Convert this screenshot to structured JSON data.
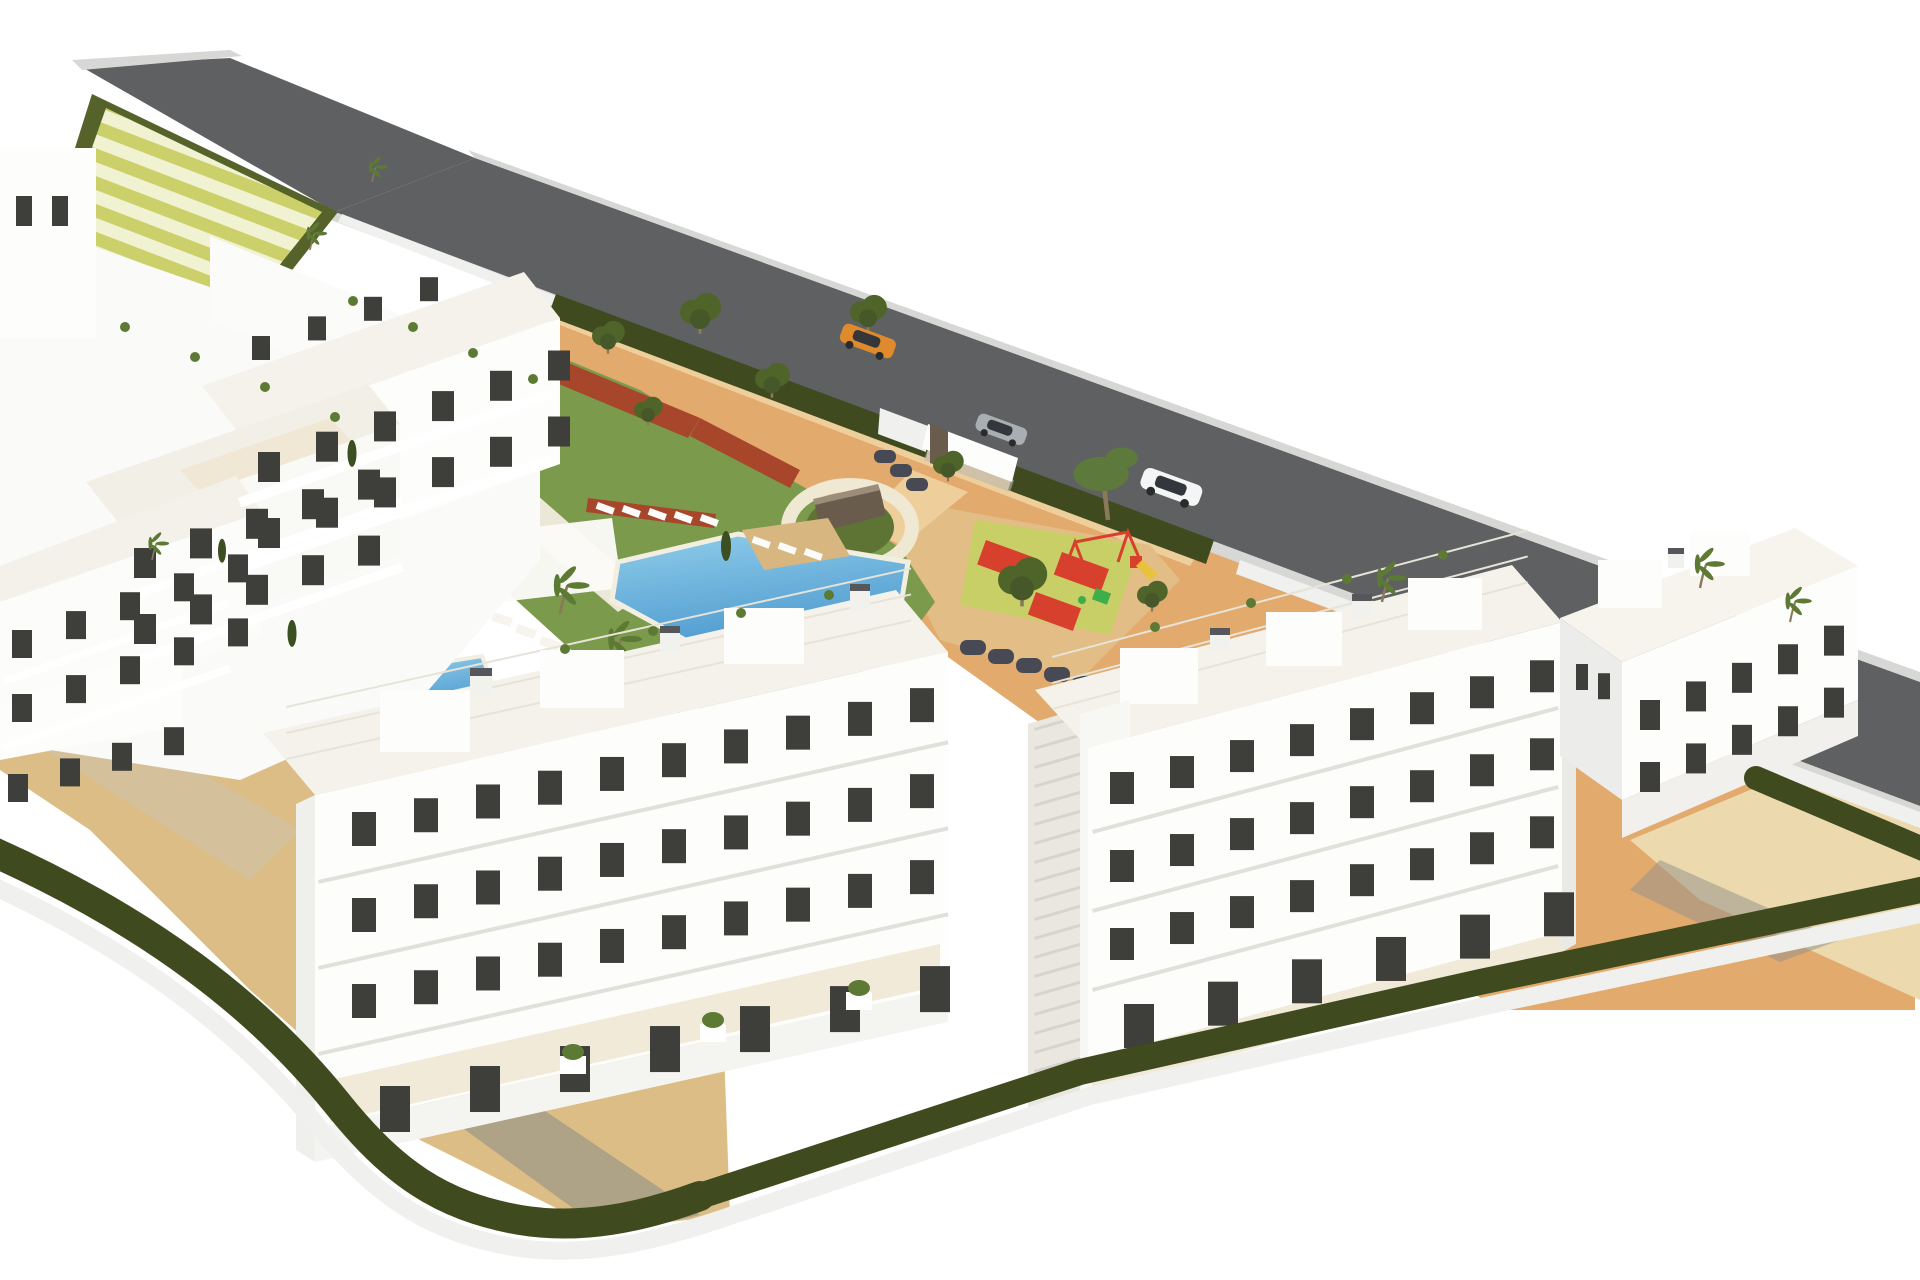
{
  "scene": {
    "type": "architectural-3d-render",
    "description": "Aerial 3D rendering of a white Mediterranean apartment complex with landscaped gardens, swimming pool, children's playground, terraced slope and a perimeter road",
    "objects": [
      "white apartment buildings with roof terraces",
      "large angled swimming pool and small pool",
      "sunbathing deck with loungers",
      "pergola",
      "stepping-stone garden path",
      "roundabout with stone monument sign",
      "children playground with red safety mats",
      "terraced slope with hedges",
      "perimeter road",
      "orange car",
      "silver car",
      "white suv",
      "perimeter hedges and boundary wall",
      "sand plaza",
      "olive trees",
      "palm trees"
    ]
  },
  "cars": [
    {
      "name": "orange-car",
      "color_key": "car_orange"
    },
    {
      "name": "silver-car",
      "color_key": "car_silver"
    },
    {
      "name": "white-suv",
      "color_key": "car_white"
    }
  ],
  "buildings": {
    "front_building_floors": 4,
    "right_building_floors": 4,
    "left_complex_terraced_wings": 4,
    "far_right_building_floors": 3
  },
  "colors": {
    "page_bg": "#ffffff",
    "road": "#5e6062",
    "road_edge": "#d7d7d5",
    "boundary_wall": "#f0f0ee",
    "hedge": "#3f4a1e",
    "hedge_light": "#55622a",
    "stripe_a": "#ccd06b",
    "stripe_b": "#f1f2d2",
    "lawn": "#7b9a4b",
    "sand": "#dcbd86",
    "sand_light": "#ecd9ad",
    "terracotta": "#e3aa6e",
    "path_tan": "#eecf9c",
    "play_sand": "#e2bd85",
    "play_mat": "#c9cf67",
    "play_red": "#d8402e",
    "play_green": "#3fae4a",
    "pool_deep": "#4f9bd0",
    "pool_light": "#90cdea",
    "pool_edge": "#f3efe0",
    "deck_tan": "#d8b680",
    "building_white": "#fdfdfc",
    "building_shade": "#ececea",
    "building_dark": "#dededa",
    "roof_light": "#f4f2ea",
    "roof_terrace": "#f0e8d5",
    "window": "#3e3e3a",
    "red_shrub": "#a8462b",
    "dark_bush": "#474a54",
    "tree_olive": "#4f6428",
    "tree_olive_dark": "#46582a",
    "tree_palm": "#5d7a35",
    "tree_pine": "#5d7a3c",
    "cypress": "#3c4f22",
    "trunk": "#8a7a5a",
    "stone_wall": "#6a5c4d",
    "stone_wall_top": "#9b8d7a",
    "shadow_dark": "#8f8f89",
    "shadow_warm": "#c9c3b4",
    "car_orange": "#e08a2e",
    "car_silver": "#a9aeb3",
    "car_white": "#f4f5f5",
    "car_glass": "#33373c",
    "step_gray": "#d6d4cc",
    "floor_line": "#e2e0da",
    "stone_white": "#f6f4ec",
    "sunbed_white": "#fbfbf9",
    "roof_grid": "#e7e3d8"
  },
  "generated": [
    {
      "t": "b1-win",
      "name": "window",
      "x0": 258,
      "y0": 452,
      "dx": 58,
      "n": 6,
      "w": 22,
      "h": 30,
      "slope": -0.35
    },
    {
      "t": "b1-win",
      "name": "window",
      "x0": 258,
      "y0": 518,
      "dx": 58,
      "n": 6,
      "w": 22,
      "h": 30,
      "slope": -0.35
    },
    {
      "t": "b1-win",
      "name": "window",
      "x0": 134,
      "y0": 548,
      "dx": 56,
      "n": 5,
      "w": 22,
      "h": 30,
      "slope": -0.35
    },
    {
      "t": "b1-win",
      "name": "window",
      "x0": 134,
      "y0": 614,
      "dx": 56,
      "n": 5,
      "w": 22,
      "h": 30,
      "slope": -0.35
    },
    {
      "t": "b1-win",
      "name": "window",
      "x0": 12,
      "y0": 630,
      "dx": 54,
      "n": 5,
      "w": 20,
      "h": 28,
      "slope": -0.35
    },
    {
      "t": "b1-win",
      "name": "window",
      "x0": 12,
      "y0": 694,
      "dx": 54,
      "n": 5,
      "w": 20,
      "h": 28,
      "slope": -0.35
    },
    {
      "t": "b1-win",
      "name": "window",
      "x0": 8,
      "y0": 774,
      "dx": 52,
      "n": 4,
      "w": 20,
      "h": 28,
      "slope": -0.3
    },
    {
      "t": "b1-win",
      "name": "window",
      "x0": 16,
      "y0": 196,
      "dx": 36,
      "n": 2,
      "w": 16,
      "h": 30
    },
    {
      "t": "b1-win",
      "name": "window",
      "x0": 252,
      "y0": 336,
      "dx": 56,
      "n": 4,
      "w": 18,
      "h": 24,
      "slope": -0.35
    },
    {
      "t": "b2-win",
      "name": "window",
      "x0": 352,
      "y0": 812,
      "dx": 62,
      "n": 10,
      "w": 24,
      "h": 34,
      "slope": -0.222
    },
    {
      "t": "b2-win",
      "name": "window",
      "x0": 352,
      "y0": 898,
      "dx": 62,
      "n": 10,
      "w": 24,
      "h": 34,
      "slope": -0.222
    },
    {
      "t": "b2-win",
      "name": "window",
      "x0": 352,
      "y0": 984,
      "dx": 62,
      "n": 10,
      "w": 24,
      "h": 34,
      "slope": -0.222
    },
    {
      "t": "b2-win",
      "name": "door",
      "x0": 380,
      "y0": 1086,
      "dx": 90,
      "n": 7,
      "w": 30,
      "h": 46,
      "slope": -0.222
    },
    {
      "t": "b3-win",
      "name": "window",
      "x0": 1110,
      "y0": 772,
      "dx": 60,
      "n": 8,
      "w": 24,
      "h": 32,
      "slope": -0.266
    },
    {
      "t": "b3-win",
      "name": "window",
      "x0": 1110,
      "y0": 850,
      "dx": 60,
      "n": 8,
      "w": 24,
      "h": 32,
      "slope": -0.266
    },
    {
      "t": "b3-win",
      "name": "window",
      "x0": 1110,
      "y0": 928,
      "dx": 60,
      "n": 8,
      "w": 24,
      "h": 32,
      "slope": -0.266
    },
    {
      "t": "b3-win",
      "name": "door",
      "x0": 1124,
      "y0": 1004,
      "dx": 84,
      "n": 6,
      "w": 30,
      "h": 44,
      "slope": -0.266
    },
    {
      "t": "b4-win",
      "name": "window",
      "x0": 1640,
      "y0": 700,
      "dx": 46,
      "n": 5,
      "w": 20,
      "h": 30,
      "slope": -0.404
    },
    {
      "t": "b4-win",
      "name": "window",
      "x0": 1640,
      "y0": 762,
      "dx": 46,
      "n": 5,
      "w": 20,
      "h": 30,
      "slope": -0.404
    },
    {
      "t": "b4-win",
      "name": "window",
      "x0": 1576,
      "y0": 664,
      "dx": 22,
      "n": 2,
      "w": 12,
      "h": 26,
      "slope": 0.42
    },
    {
      "t": "steps",
      "name": "stair-step",
      "x0": 1034,
      "y0": 728,
      "dy": 19,
      "n": 19,
      "w": 52,
      "h": 3,
      "rot": -16
    },
    {
      "t": "b2-lines",
      "name": "floor-shadow",
      "x0": 318,
      "y0": 880,
      "dy": 86,
      "n": 3,
      "w": 645,
      "h": 4,
      "rot": -12.5
    },
    {
      "t": "b3-lines",
      "name": "floor-shadow",
      "x0": 1092,
      "y0": 830,
      "dy": 79,
      "n": 3,
      "w": 482,
      "h": 4,
      "rot": -14.9
    },
    {
      "t": "b1-slabs",
      "name": "balcony-slab",
      "x0": 238,
      "y0": 498,
      "dy": 66,
      "n": 2,
      "w": 330,
      "h": 10,
      "rot": -19.3
    },
    {
      "t": "b1-slabs",
      "name": "balcony-slab",
      "x0": 118,
      "y0": 596,
      "dy": 66,
      "n": 2,
      "w": 300,
      "h": 9,
      "rot": -19.3
    },
    {
      "t": "b1-slabs",
      "name": "balcony-slab",
      "x0": 2,
      "y0": 678,
      "dy": 66,
      "n": 2,
      "w": 240,
      "h": 8,
      "rot": -19.3
    },
    {
      "t": "stones",
      "name": "stepping-stone",
      "x0": 470,
      "y0": 600,
      "dx": 24,
      "dy": 12,
      "n": 13,
      "w": 20,
      "h": 9,
      "rot": 19
    },
    {
      "t": "stones",
      "name": "stepping-stone",
      "x0": 784,
      "y0": 740,
      "dx": 26,
      "dy": -7,
      "n": 4,
      "w": 20,
      "h": 9,
      "rot": 10
    },
    {
      "t": "sunbeds",
      "name": "sunbed",
      "x0": 598,
      "y0": 502,
      "dx": 26,
      "dy": 3,
      "n": 5,
      "w": 18,
      "h": 7,
      "rot": 20
    },
    {
      "t": "sunbeds",
      "name": "sunbed",
      "x0": 754,
      "y0": 536,
      "dx": 26,
      "dy": 6,
      "n": 3,
      "w": 18,
      "h": 7,
      "rot": 20
    },
    {
      "t": "sunbeds",
      "name": "sunbed",
      "x0": 418,
      "y0": 722,
      "dx": 26,
      "dy": 6,
      "n": 3,
      "w": 18,
      "h": 7,
      "rot": 20
    },
    {
      "t": "bushes",
      "name": "bush",
      "x0": 318,
      "y0": 464,
      "dx": 11,
      "dy": 27,
      "n": 5,
      "w": 24,
      "h": 16,
      "rx": 7
    },
    {
      "t": "bushes",
      "name": "bush",
      "x0": 960,
      "y0": 640,
      "dx": 28,
      "dy": 9,
      "n": 5,
      "w": 26,
      "h": 15,
      "rx": 7
    },
    {
      "t": "bushes",
      "name": "bush",
      "x0": 874,
      "y0": 450,
      "dx": 16,
      "dy": 14,
      "n": 3,
      "w": 22,
      "h": 13,
      "rx": 6
    },
    {
      "t": "redshrub-dots",
      "name": "shrub",
      "x0": 770,
      "y0": 536,
      "dx": 13,
      "dy": 12,
      "n": 4,
      "w": 12,
      "h": 9,
      "rx": 4
    },
    {
      "t": "b2-roofgrid",
      "name": "roof-line",
      "x0": 286,
      "y0": 706,
      "dy": 26,
      "n": 3,
      "w": 640,
      "h": 2,
      "rot": -12.5
    },
    {
      "t": "b3-roofgrid",
      "name": "roof-line",
      "x0": 1052,
      "y0": 656,
      "dy": 26,
      "n": 3,
      "w": 492,
      "h": 2,
      "rot": -14.9
    },
    {
      "t": "roof-plants",
      "name": "roof-plant",
      "x0": 348,
      "y0": 296,
      "dx": 60,
      "dy": 26,
      "n": 4,
      "w": 10,
      "h": 10,
      "rx": 5
    },
    {
      "t": "roof-plants",
      "name": "roof-plant",
      "x0": 560,
      "y0": 644,
      "dx": 88,
      "dy": -18,
      "n": 4,
      "w": 10,
      "h": 10,
      "rx": 5
    },
    {
      "t": "roof-plants",
      "name": "roof-plant",
      "x0": 1150,
      "y0": 622,
      "dx": 96,
      "dy": -24,
      "n": 4,
      "w": 10,
      "h": 10,
      "rx": 5
    },
    {
      "t": "roof-plants",
      "name": "roof-plant",
      "x0": 120,
      "y0": 322,
      "dx": 70,
      "dy": 30,
      "n": 4,
      "w": 10,
      "h": 10,
      "rx": 5
    }
  ]
}
